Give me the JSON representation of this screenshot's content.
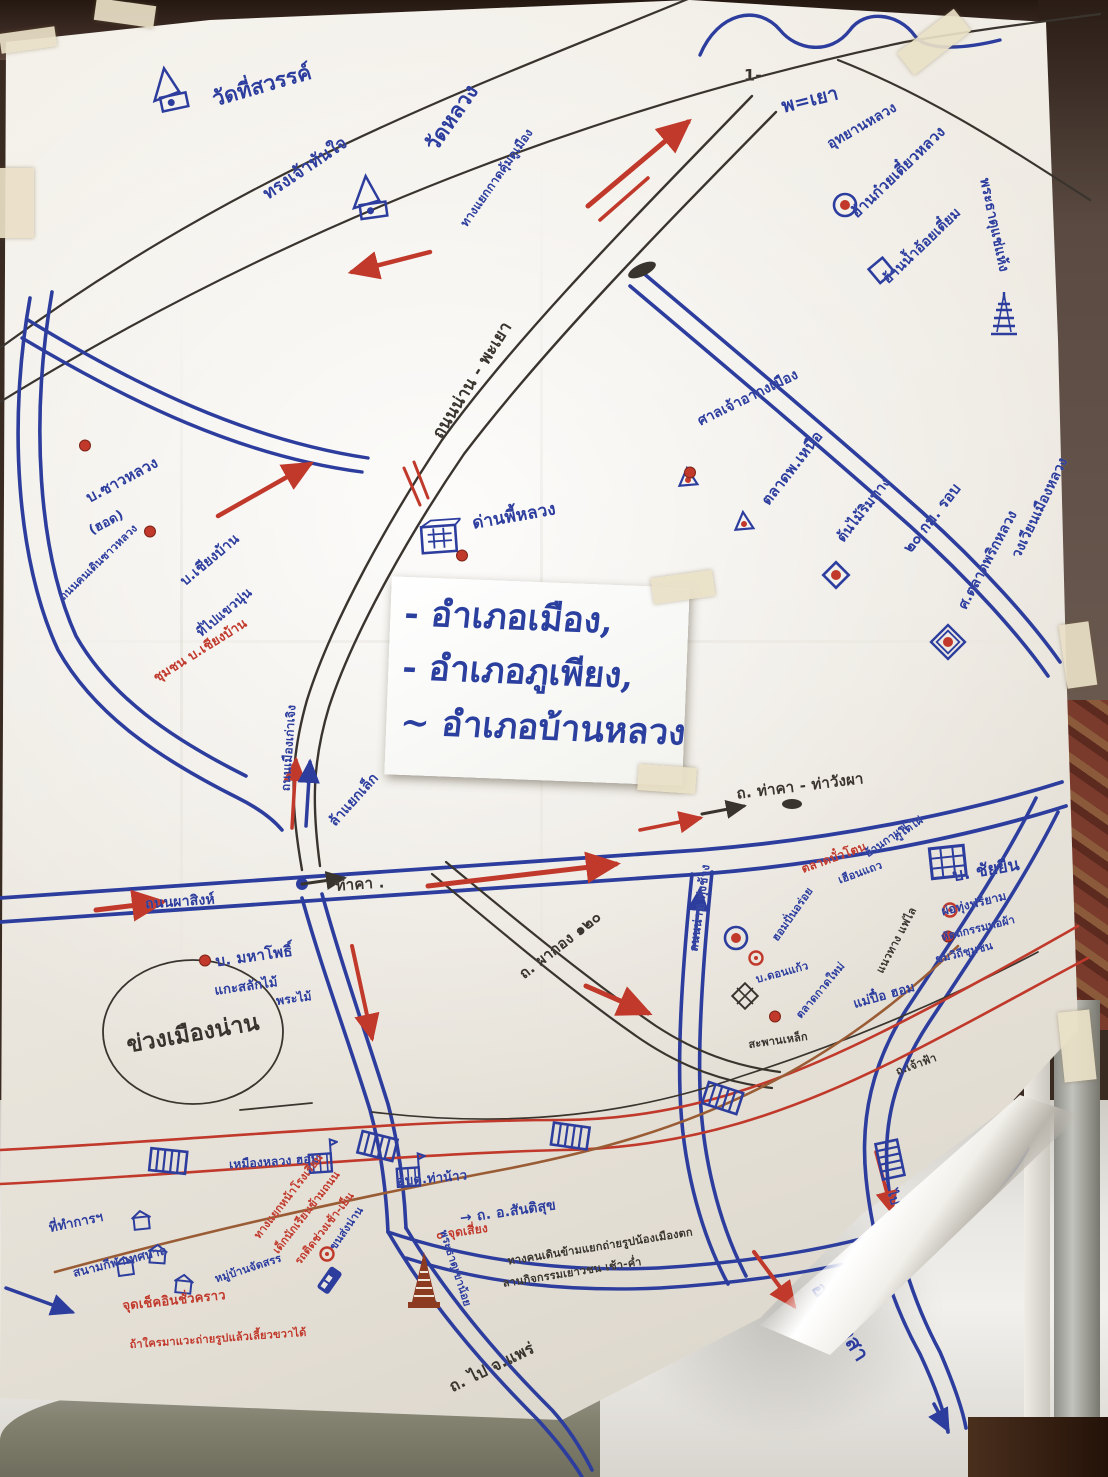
{
  "districts_sign": {
    "lines": [
      "- อำเภอเมือง,",
      "- อำเภอภูเพียง,",
      "~ อำเภอบ้านหลวง"
    ]
  },
  "colors": {
    "marker_blue": "#2c3d9e",
    "marker_red": "#c0392b",
    "ink_dark": "#3a342e",
    "river_brown": "#9a5c35",
    "paper": "#efece6",
    "sign_blue": "#2b3f9f"
  },
  "map_labels": [
    {
      "text": "วัดที่สวรรค์",
      "x": 262,
      "y": 86,
      "rot": -16,
      "color": "blue",
      "size": 21
    },
    {
      "text": "ทรงเจ้าทันใจ",
      "x": 305,
      "y": 168,
      "rot": -34,
      "color": "blue",
      "size": 17
    },
    {
      "text": "วัดหลวง",
      "x": 452,
      "y": 118,
      "rot": -55,
      "color": "blue",
      "size": 21
    },
    {
      "text": "ทางแยกกาดคุ้มดูเมือง",
      "x": 497,
      "y": 178,
      "rot": -55,
      "color": "blue",
      "size": 12
    },
    {
      "text": "1-",
      "x": 753,
      "y": 75,
      "rot": 0,
      "color": "dark",
      "size": 16
    },
    {
      "text": "พ=เยา",
      "x": 810,
      "y": 100,
      "rot": -14,
      "color": "blue",
      "size": 19
    },
    {
      "text": "อุทยานหลวง",
      "x": 862,
      "y": 126,
      "rot": -30,
      "color": "blue",
      "size": 14
    },
    {
      "text": "ฮ้านก๋วยเตี๋ยวหลวง",
      "x": 898,
      "y": 172,
      "rot": -44,
      "color": "blue",
      "size": 15
    },
    {
      "text": "ฮ้านน้ำอ้อยเตี๋ยม",
      "x": 922,
      "y": 246,
      "rot": -44,
      "color": "blue",
      "size": 14
    },
    {
      "text": "พระธาตุแช่แห้ง",
      "x": 994,
      "y": 225,
      "rot": 78,
      "color": "blue",
      "size": 14
    },
    {
      "text": "ถนนน่าน - พะเยา",
      "x": 472,
      "y": 380,
      "rot": -58,
      "color": "dark",
      "size": 17
    },
    {
      "text": "ศาลเจ้าอากงเมือง",
      "x": 748,
      "y": 398,
      "rot": -26,
      "color": "blue",
      "size": 14
    },
    {
      "text": "ตลาดพ.เหนือ",
      "x": 792,
      "y": 468,
      "rot": -52,
      "color": "blue",
      "size": 15
    },
    {
      "text": "ต้นไม้ริมทาง",
      "x": 864,
      "y": 510,
      "rot": -52,
      "color": "blue",
      "size": 14
    },
    {
      "text": "๒๐ กม. รอบ",
      "x": 932,
      "y": 518,
      "rot": -52,
      "color": "blue",
      "size": 15
    },
    {
      "text": "ศ.ตลาดพริกหลวง",
      "x": 988,
      "y": 560,
      "rot": -62,
      "color": "blue",
      "size": 14
    },
    {
      "text": "วงเวียนเมืองหลวง",
      "x": 1040,
      "y": 508,
      "rot": -64,
      "color": "blue",
      "size": 14
    },
    {
      "text": "บ.ซาวหลวง",
      "x": 122,
      "y": 480,
      "rot": -28,
      "color": "blue",
      "size": 15
    },
    {
      "text": "(ฮอด)",
      "x": 106,
      "y": 522,
      "rot": -28,
      "color": "blue",
      "size": 13
    },
    {
      "text": "ถนนคนเดินซาวหลวง",
      "x": 98,
      "y": 562,
      "rot": -44,
      "color": "blue",
      "size": 11
    },
    {
      "text": "บ.เชียงบ้าน",
      "x": 210,
      "y": 560,
      "rot": -40,
      "color": "blue",
      "size": 14
    },
    {
      "text": "ที่ไปแขวนุ่น",
      "x": 224,
      "y": 612,
      "rot": -40,
      "color": "blue",
      "size": 13
    },
    {
      "text": "ชุมชน บ.เชียงบ้าน",
      "x": 200,
      "y": 650,
      "rot": -32,
      "color": "red",
      "size": 13
    },
    {
      "text": "ด่านพี้หลวง",
      "x": 514,
      "y": 516,
      "rot": -10,
      "color": "blue",
      "size": 17
    },
    {
      "text": "ถนนเมืองเก่าเจิง",
      "x": 289,
      "y": 748,
      "rot": -86,
      "color": "blue",
      "size": 12
    },
    {
      "text": "ล้าแยกเล็ก",
      "x": 354,
      "y": 800,
      "rot": -48,
      "color": "blue",
      "size": 14
    },
    {
      "text": "ถ. ท่าคา - ท่าวังผา",
      "x": 800,
      "y": 786,
      "rot": -7,
      "color": "dark",
      "size": 15
    },
    {
      "text": "ท่าคา .",
      "x": 360,
      "y": 884,
      "rot": -4,
      "color": "dark",
      "size": 15
    },
    {
      "text": "ถนนผาสิงห์",
      "x": 180,
      "y": 902,
      "rot": -4,
      "color": "blue",
      "size": 14
    },
    {
      "text": "บ. มหาโพธิ์",
      "x": 254,
      "y": 956,
      "rot": -8,
      "color": "blue",
      "size": 15
    },
    {
      "text": "แกะสลักไม้",
      "x": 246,
      "y": 986,
      "rot": -8,
      "color": "blue",
      "size": 13
    },
    {
      "text": "พระไม้",
      "x": 294,
      "y": 999,
      "rot": -8,
      "color": "blue",
      "size": 12
    },
    {
      "text": "ข่วงเมืองน่าน",
      "x": 193,
      "y": 1034,
      "rot": -10,
      "color": "dark",
      "size": 23
    },
    {
      "text": "ถ. ผากอง ๑๒๐",
      "x": 560,
      "y": 945,
      "rot": -38,
      "color": "dark",
      "size": 15
    },
    {
      "text": "ถนนน่าน ทุ่งช้าง",
      "x": 700,
      "y": 908,
      "rot": -82,
      "color": "blue",
      "size": 12
    },
    {
      "text": "ตลาดบั๋วโตน",
      "x": 834,
      "y": 858,
      "rot": -20,
      "color": "red",
      "size": 12
    },
    {
      "text": "เฮือนแถว",
      "x": 860,
      "y": 872,
      "rot": -20,
      "color": "blue",
      "size": 11
    },
    {
      "text": "ฮ้านกาแฟ",
      "x": 886,
      "y": 840,
      "rot": -35,
      "color": "blue",
      "size": 11
    },
    {
      "text": "ภูโตไผ่",
      "x": 908,
      "y": 828,
      "rot": -35,
      "color": "blue",
      "size": 11
    },
    {
      "text": "บ. ชัยยืน",
      "x": 986,
      "y": 870,
      "rot": -10,
      "color": "blue",
      "size": 17
    },
    {
      "text": "ผ่อทุ่งฟรียาม",
      "x": 974,
      "y": 904,
      "rot": -14,
      "color": "blue",
      "size": 12
    },
    {
      "text": "หัตถกรรมทอผ้า",
      "x": 978,
      "y": 928,
      "rot": -14,
      "color": "blue",
      "size": 11
    },
    {
      "text": "ชมวิถีชุมชน",
      "x": 964,
      "y": 952,
      "rot": -14,
      "color": "blue",
      "size": 11
    },
    {
      "text": "แนวทาง แฟไล",
      "x": 896,
      "y": 940,
      "rot": -62,
      "color": "dark",
      "size": 11
    },
    {
      "text": "แม่ปื๋อ ฮอม",
      "x": 884,
      "y": 995,
      "rot": -16,
      "color": "blue",
      "size": 13
    },
    {
      "text": "ฮอมปั่นอร่อย",
      "x": 792,
      "y": 914,
      "rot": -55,
      "color": "blue",
      "size": 11
    },
    {
      "text": "บ.ดอนแก้ว",
      "x": 782,
      "y": 972,
      "rot": -15,
      "color": "blue",
      "size": 11
    },
    {
      "text": "ตลาดกาดใหม่",
      "x": 820,
      "y": 990,
      "rot": -50,
      "color": "blue",
      "size": 11
    },
    {
      "text": "สะพานเหล็ก",
      "x": 778,
      "y": 1040,
      "rot": -8,
      "color": "dark",
      "size": 11
    },
    {
      "text": "ถ.เจ้าฟ้า",
      "x": 916,
      "y": 1064,
      "rot": -20,
      "color": "dark",
      "size": 11
    },
    {
      "text": "เหมืองหลวง ฮอม",
      "x": 274,
      "y": 1162,
      "rot": -4,
      "color": "blue",
      "size": 12
    },
    {
      "text": "อบต.ท่าน้าว",
      "x": 432,
      "y": 1178,
      "rot": -5,
      "color": "blue",
      "size": 13
    },
    {
      "text": "ทางแยกหน้าโรงเรียน",
      "x": 288,
      "y": 1196,
      "rot": -52,
      "color": "red",
      "size": 11
    },
    {
      "text": "เด็กนักเรียนข้ามถนน",
      "x": 306,
      "y": 1212,
      "rot": -52,
      "color": "red",
      "size": 11
    },
    {
      "text": "รถติดช่วงเช้า-เย็น",
      "x": 324,
      "y": 1228,
      "rot": -52,
      "color": "red",
      "size": 11
    },
    {
      "text": "ขนส่งน่าน",
      "x": 346,
      "y": 1228,
      "rot": -55,
      "color": "blue",
      "size": 11
    },
    {
      "text": "ที่ทำการฯ",
      "x": 76,
      "y": 1222,
      "rot": -12,
      "color": "blue",
      "size": 13
    },
    {
      "text": "สนามกีฬาเทศบาล",
      "x": 120,
      "y": 1262,
      "rot": -14,
      "color": "blue",
      "size": 12
    },
    {
      "text": "หมู่บ้านจัดสรร",
      "x": 248,
      "y": 1268,
      "rot": -18,
      "color": "blue",
      "size": 11
    },
    {
      "text": "จุดเช็คอินชั่วคราว",
      "x": 174,
      "y": 1300,
      "rot": -6,
      "color": "red",
      "size": 13
    },
    {
      "text": "ถ้าใครมาแวะถ่ายรูปแล้วเลี้ยวขวาได้",
      "x": 218,
      "y": 1338,
      "rot": -4,
      "color": "red",
      "size": 11
    },
    {
      "text": "๐ จุดเสี่ยง",
      "x": 462,
      "y": 1232,
      "rot": -8,
      "color": "red",
      "size": 12
    },
    {
      "text": "พระธาตุเขาน้อย",
      "x": 456,
      "y": 1268,
      "rot": 72,
      "color": "blue",
      "size": 11
    },
    {
      "text": "→ ถ. อ.สันติสุข",
      "x": 508,
      "y": 1212,
      "rot": -8,
      "color": "blue",
      "size": 14
    },
    {
      "text": "ทางคนเดินข้ามแยกถ่ายรูปน้องเมืองตก",
      "x": 600,
      "y": 1246,
      "rot": -9,
      "color": "dark",
      "size": 11
    },
    {
      "text": "ลานกิจกรรมเยาวชน เช้า-ค่ำ",
      "x": 572,
      "y": 1272,
      "rot": -9,
      "color": "dark",
      "size": 11
    },
    {
      "text": "ถ. ไป จ.แพร่",
      "x": 492,
      "y": 1368,
      "rot": -26,
      "color": "dark",
      "size": 16
    },
    {
      "text": "ไป อ.เวียงสา",
      "x": 902,
      "y": 1226,
      "rot": 74,
      "color": "blue",
      "size": 13
    },
    {
      "text": "อ.เวียงสา",
      "x": 840,
      "y": 1322,
      "rot": 58,
      "color": "blue",
      "size": 21
    }
  ],
  "map_icons": [
    {
      "type": "temple",
      "x": 168,
      "y": 92,
      "rot": -12
    },
    {
      "type": "temple",
      "x": 368,
      "y": 200,
      "rot": -8
    },
    {
      "type": "shrine",
      "x": 688,
      "y": 480,
      "rot": -5
    },
    {
      "type": "shrine",
      "x": 744,
      "y": 524,
      "rot": -5
    },
    {
      "type": "chedi-blue",
      "x": 1004,
      "y": 315,
      "rot": 0
    },
    {
      "type": "chedi-red",
      "x": 424,
      "y": 1282,
      "rot": 0
    },
    {
      "type": "market",
      "x": 440,
      "y": 540,
      "rot": -4
    },
    {
      "type": "building",
      "x": 948,
      "y": 864,
      "rot": -6
    },
    {
      "type": "square",
      "x": 884,
      "y": 272,
      "rot": -40
    },
    {
      "type": "diamond",
      "x": 836,
      "y": 577,
      "rot": 0
    },
    {
      "type": "diamond-double",
      "x": 948,
      "y": 644,
      "rot": 0
    },
    {
      "type": "circle-dot",
      "x": 845,
      "y": 207,
      "rot": 0
    },
    {
      "type": "circle-dot",
      "x": 736,
      "y": 940,
      "rot": 0
    },
    {
      "type": "red-ring",
      "x": 756,
      "y": 960,
      "rot": 0
    },
    {
      "type": "red-ring",
      "x": 950,
      "y": 912,
      "rot": 0
    },
    {
      "type": "red-ring",
      "x": 327,
      "y": 1256,
      "rot": 0
    },
    {
      "type": "red-dot",
      "x": 85,
      "y": 447,
      "rot": 0
    },
    {
      "type": "red-dot",
      "x": 150,
      "y": 533,
      "rot": 0
    },
    {
      "type": "red-dot",
      "x": 462,
      "y": 557,
      "rot": 0
    },
    {
      "type": "red-dot",
      "x": 205,
      "y": 962,
      "rot": 0
    },
    {
      "type": "red-dot",
      "x": 690,
      "y": 474,
      "rot": 0
    },
    {
      "type": "red-dot",
      "x": 775,
      "y": 1018,
      "rot": 0
    },
    {
      "type": "red-dot",
      "x": 948,
      "y": 938,
      "rot": 0
    },
    {
      "type": "bridge",
      "x": 168,
      "y": 1163,
      "rot": 6
    },
    {
      "type": "bridge",
      "x": 377,
      "y": 1148,
      "rot": 14
    },
    {
      "type": "bridge",
      "x": 570,
      "y": 1138,
      "rot": 8
    },
    {
      "type": "bridge",
      "x": 722,
      "y": 1100,
      "rot": 18
    },
    {
      "type": "bridge",
      "x": 888,
      "y": 1160,
      "rot": 78
    },
    {
      "type": "bridge-diamond",
      "x": 745,
      "y": 998,
      "rot": 0
    },
    {
      "type": "bus",
      "x": 332,
      "y": 1282,
      "rot": -55
    },
    {
      "type": "flag-building",
      "x": 322,
      "y": 1158,
      "rot": -4
    },
    {
      "type": "flag-building",
      "x": 410,
      "y": 1172,
      "rot": -4
    },
    {
      "type": "house",
      "x": 142,
      "y": 1222,
      "rot": -6
    },
    {
      "type": "house",
      "x": 158,
      "y": 1256,
      "rot": 4
    },
    {
      "type": "house",
      "x": 126,
      "y": 1268,
      "rot": -8
    },
    {
      "type": "house",
      "x": 184,
      "y": 1286,
      "rot": 6
    }
  ]
}
